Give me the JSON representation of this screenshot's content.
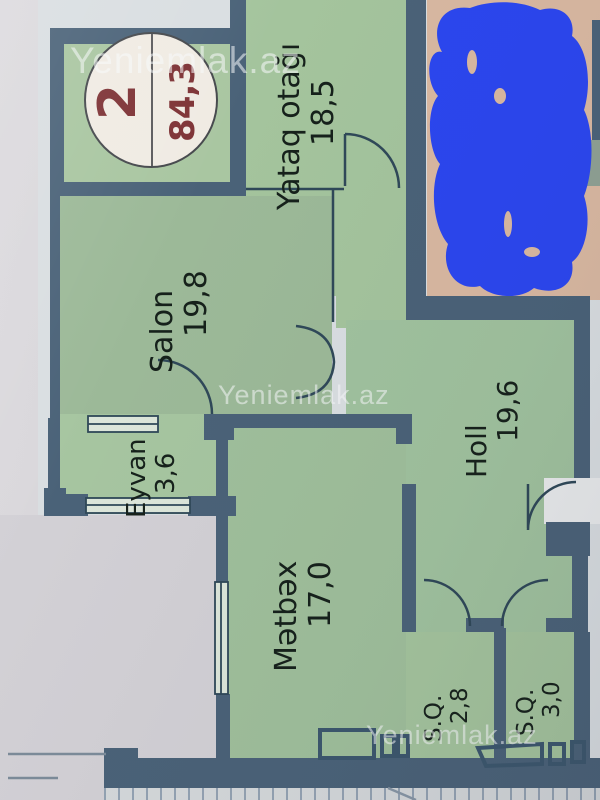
{
  "photo": {
    "watermark_text": "Yeniemlak.az",
    "stamp": {
      "apartment_number": "2",
      "total_area": "84,3"
    },
    "rooms": [
      {
        "name": "Yataq otağı",
        "area": "18,5"
      },
      {
        "name": "Salon",
        "area": "19,8"
      },
      {
        "name": "Holl",
        "area": "19,6"
      },
      {
        "name": "Eyvan",
        "area": "3,6"
      },
      {
        "name": "Mətbəx",
        "area": "17,0"
      },
      {
        "name": "S.Q.",
        "area": "2,8"
      },
      {
        "name": "S.Q.",
        "area": "3,0"
      }
    ],
    "colors": {
      "wall": "#4a6278",
      "room_fill": "#a4c49d",
      "balcony_fill": "#d9b8a1",
      "scribble_blue": "#2b46ef",
      "stamp_text": "#7e3336",
      "label_text": "#16211b",
      "paper": "#d5d3d7",
      "sheet": "#d9dee1"
    }
  }
}
